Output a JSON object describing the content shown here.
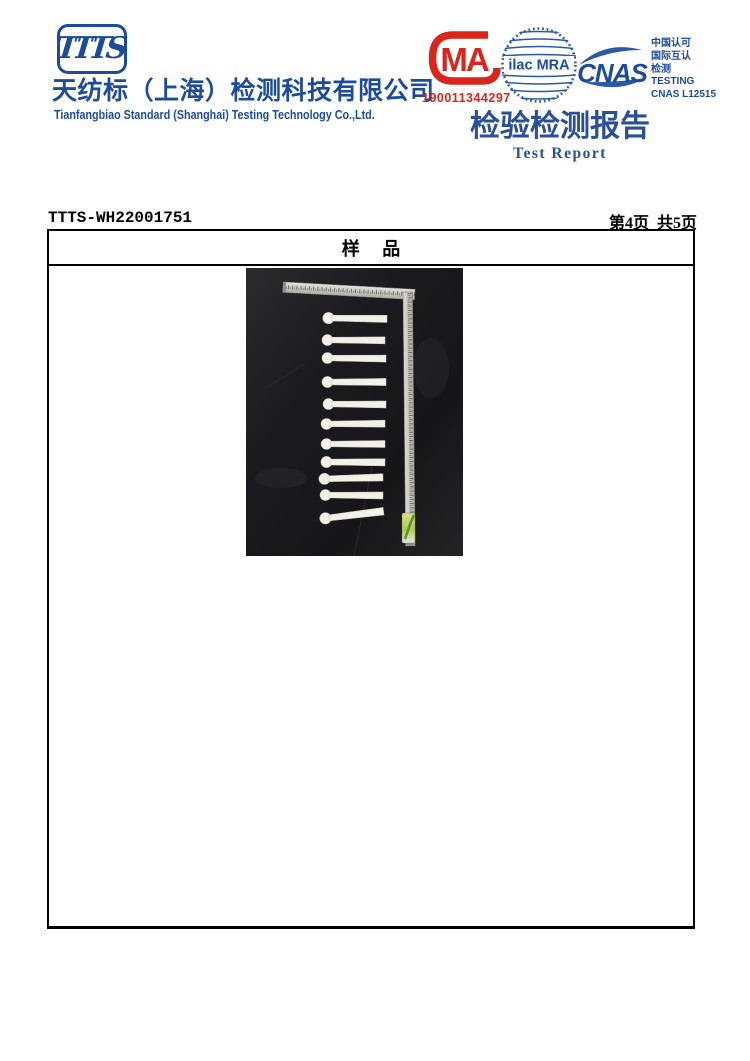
{
  "brand": {
    "logo_text": "TTTS",
    "company_name_zh": "天纺标（上海）检测科技有限公司",
    "company_name_en": "Tianfangbiao Standard (Shanghai) Testing Technology Co.,Ltd."
  },
  "accreditation": {
    "cma": {
      "label": "MA",
      "number": "190011344297"
    },
    "ilac": {
      "label": "ilac MRA"
    },
    "cnas": {
      "label": "CNAS",
      "side_lines": [
        "中国认可",
        "国际互认",
        "检测",
        "TESTING",
        "CNAS L12515"
      ]
    }
  },
  "report_title": {
    "zh": "检验检测报告",
    "en": "Test Report"
  },
  "page_header": {
    "report_no": "TTTS-WH22001751",
    "page_info": "第4页 共5页"
  },
  "sample_section": {
    "title": "样 品"
  },
  "sample_photo": {
    "alt": "Eleven white paddle-shaped test samples laid in a column beside an L-shaped steel ruler on a black background; small green label at the lower end of the ruler",
    "stick_count": 11
  },
  "colors": {
    "brand_blue": "#1d4b9c",
    "title_blue": "#2a4f97",
    "cma_red": "#d9251c",
    "photo_background": "#1b1b1e",
    "stick_color": "#f2f0e9"
  }
}
